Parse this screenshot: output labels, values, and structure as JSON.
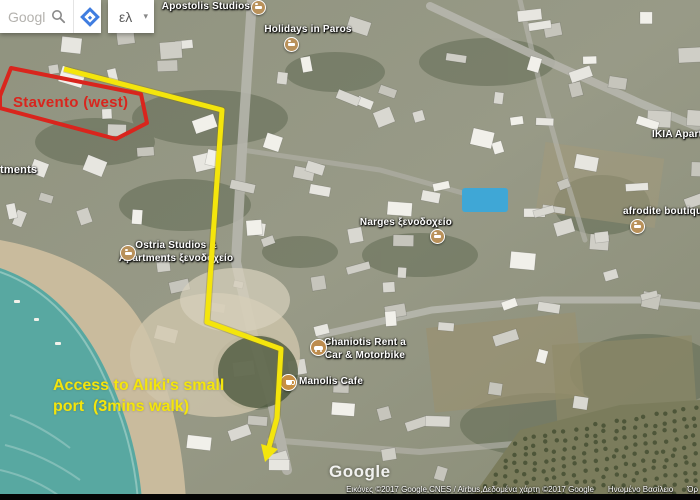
{
  "toolbar": {
    "search_value": "Googl",
    "language_label": "ελ",
    "caret": "▾",
    "accent_blue": "#3f7de0"
  },
  "map_labels": [
    {
      "text": "Apostolis Studios",
      "icon": "lodging"
    },
    {
      "text": "Holidays in Paros",
      "icon": "lodging"
    },
    {
      "text": "tments"
    },
    {
      "text": "IKIA Apartm"
    },
    {
      "text": "afrodite boutique",
      "icon": "lodging"
    },
    {
      "text": "Narges ξενοδοχείο",
      "icon": "lodging"
    },
    {
      "text": "Ostria Studios &",
      "text2": "Apartments ξενοδοχείο",
      "icon": "lodging"
    },
    {
      "text": "Chaniotis Rent a",
      "text2": "Car & Motorbike",
      "icon": "car-rental"
    },
    {
      "text": "Manolis Cafe",
      "icon": "cafe"
    }
  ],
  "annotations": {
    "red_label": "Stavento (west)",
    "red_color": "#d9251d",
    "yellow_line1": "Access to Aliki's small",
    "yellow_line2": "port  (3mins walk)",
    "yellow_color": "#f4e50c"
  },
  "watermark": "Google",
  "attribution": {
    "credits": "Εικόνες ©2017 Google,CNES / Airbus,Δεδομένα χάρτη ©2017 Google",
    "region": "Ηνωμένο Βασίλειο",
    "terms": "Όρ"
  },
  "map_colors": {
    "water": "#58a8a1",
    "sand": "#c9bb9d",
    "land": "#8f927e",
    "poi_icon": "#b9915a"
  }
}
